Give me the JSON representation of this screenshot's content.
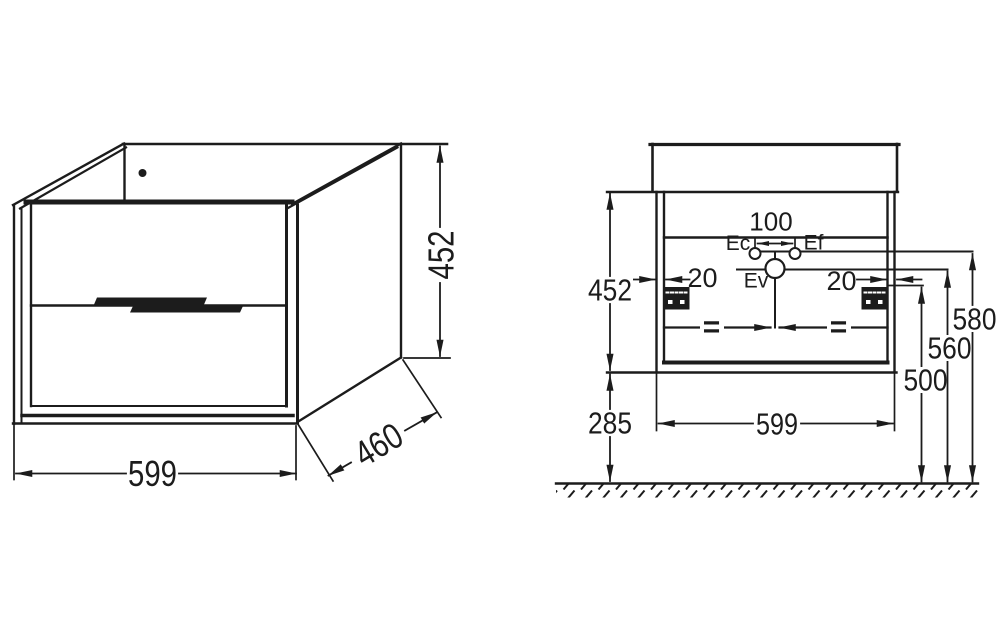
{
  "colors": {
    "line": "#1c1c1c",
    "background": "#ffffff"
  },
  "isometric_view": {
    "width_mm": "599",
    "height_mm": "452",
    "depth_mm": "460"
  },
  "front_view": {
    "cabinet_height_mm": "452",
    "cabinet_width_mm": "599",
    "floor_clearance_mm": "285",
    "tap_hole_spacing_mm": "100",
    "bracket_inset_left_mm": "20",
    "bracket_inset_right_mm": "20",
    "cold_water_label": "Ec",
    "hot_water_label": "Ef",
    "waste_outlet_label": "Ev",
    "cold_hot_height_mm": "580",
    "waste_height_mm": "560",
    "bracket_height_mm": "500",
    "equal_spacing_mark": "="
  }
}
